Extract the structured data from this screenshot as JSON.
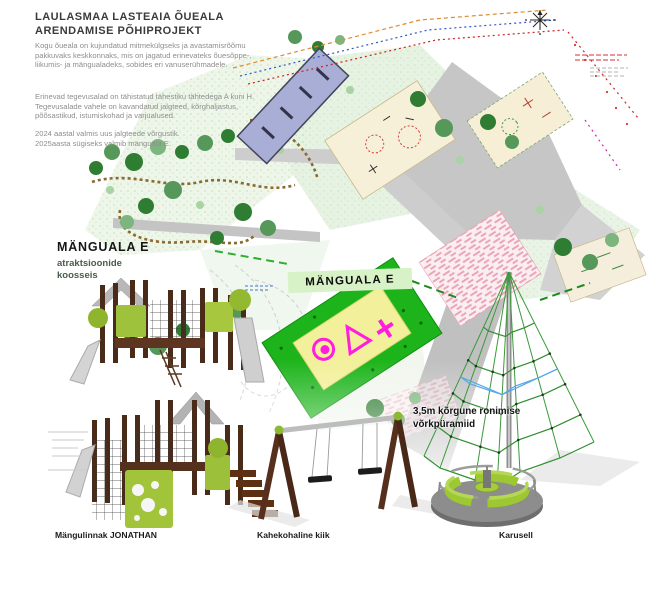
{
  "header": {
    "title_line1": "LAULASMAA LASTEAIA ÕUEALA",
    "title_line2": "ARENDAMISE PÕHIPROJEKT",
    "paragraph1": "Kogu õueala on kujundatud mitmekülgseks ja avastamisrõõmu pakkuvaks keskkonnaks, mis on jagatud erinevateks õuesõppe-, liikumis- ja mängualadeks, sobides eri vanuserühmadele.",
    "paragraph2": "Erinevad tegevusalad on tähistatud tähestiku tähtedega A kuni H. Tegevusalade vahele on kavandatud jalgteed, kõrghaljastus, põõsastikud, istumiskohad ja varjualused.",
    "paragraph3_line1": "2024 aastal valmis uus jalgteede võrgustik.",
    "paragraph3_line2": "2025aasta sügiseks valmib mänguala E."
  },
  "plan": {
    "area_label": "MÄNGUALA E",
    "side_label_title": "MÄNGUALA E",
    "side_label_subtitle_line1": "atraktsioonide",
    "side_label_subtitle_line2": "koosseis",
    "pyramid_note_line1": "3,5m kõrgune ronimise",
    "pyramid_note_line2": "võrkpüramiid"
  },
  "equipment": {
    "playhouse_label": "Mängulinnak JONATHAN",
    "swing_label": "Kahekohaline kiik",
    "carousel_label": "Karusell"
  },
  "colors": {
    "highlight_green": "#1db41b",
    "label_background": "#d8f2c8",
    "equipment_green": "#a2c43a",
    "wood_brown": "#4e2c1a",
    "slide_gray": "#cfcfcf",
    "rope_green": "#3a9a3a",
    "rope_blue": "#55a8e8"
  }
}
